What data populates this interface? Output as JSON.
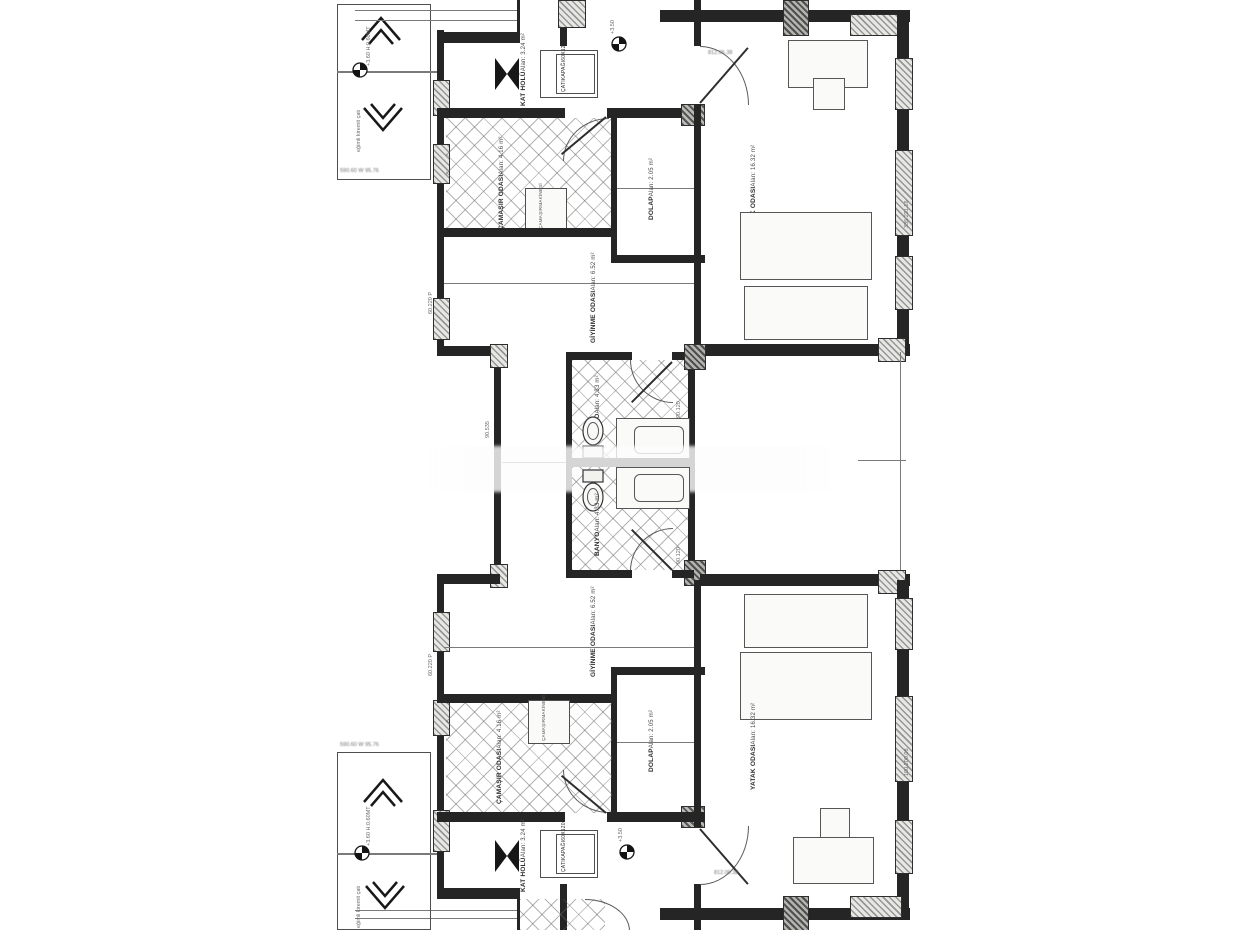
{
  "labels": {
    "kat_holu": {
      "name": "KAT HOLÜ",
      "area": "Alan: 3.24 m²"
    },
    "cati_kapagi": {
      "l1": "ÇATI",
      "l2": "KAPAĞI",
      "l3": "60X120"
    },
    "camasir": {
      "name": "ÇAMAŞIR ODASI",
      "area": "Alan: 4.16 m²"
    },
    "makine": {
      "l1": "ÇAMAŞIR",
      "l2": "MAKİNESİ"
    },
    "dolap": {
      "name": "DOLAP",
      "area": "Alan: 2.05 m²"
    },
    "giyinme": {
      "name": "GİYİNME ODASI",
      "area": "Alan: 6.52 m²"
    },
    "yatak": {
      "name": "YATAK ODASI",
      "area": "Alan: 16.32 m²"
    },
    "banyo": {
      "name": "BANYO",
      "area": "Alan: 4.33 m²"
    }
  },
  "markers": {
    "level_350": "+3.50",
    "level_360": "+3.60",
    "height_note": "H:0.60MT",
    "roof_note": "eğimli kiremit çatı"
  },
  "dims": {
    "door_top": "812.06.38",
    "door_bottom": "812.06.38",
    "left_wall_top": "60.220 P",
    "left_wall_bottom": "60.220 P",
    "corridor": "90.535",
    "bath_door_top": "90.120",
    "bath_door_bottom": "90.120",
    "right_wall_top": "335.231.16",
    "right_wall_bottom": "100.200.08",
    "box_top": "590.60 W 95.76",
    "box_bottom": "590.60 W 95.76"
  }
}
